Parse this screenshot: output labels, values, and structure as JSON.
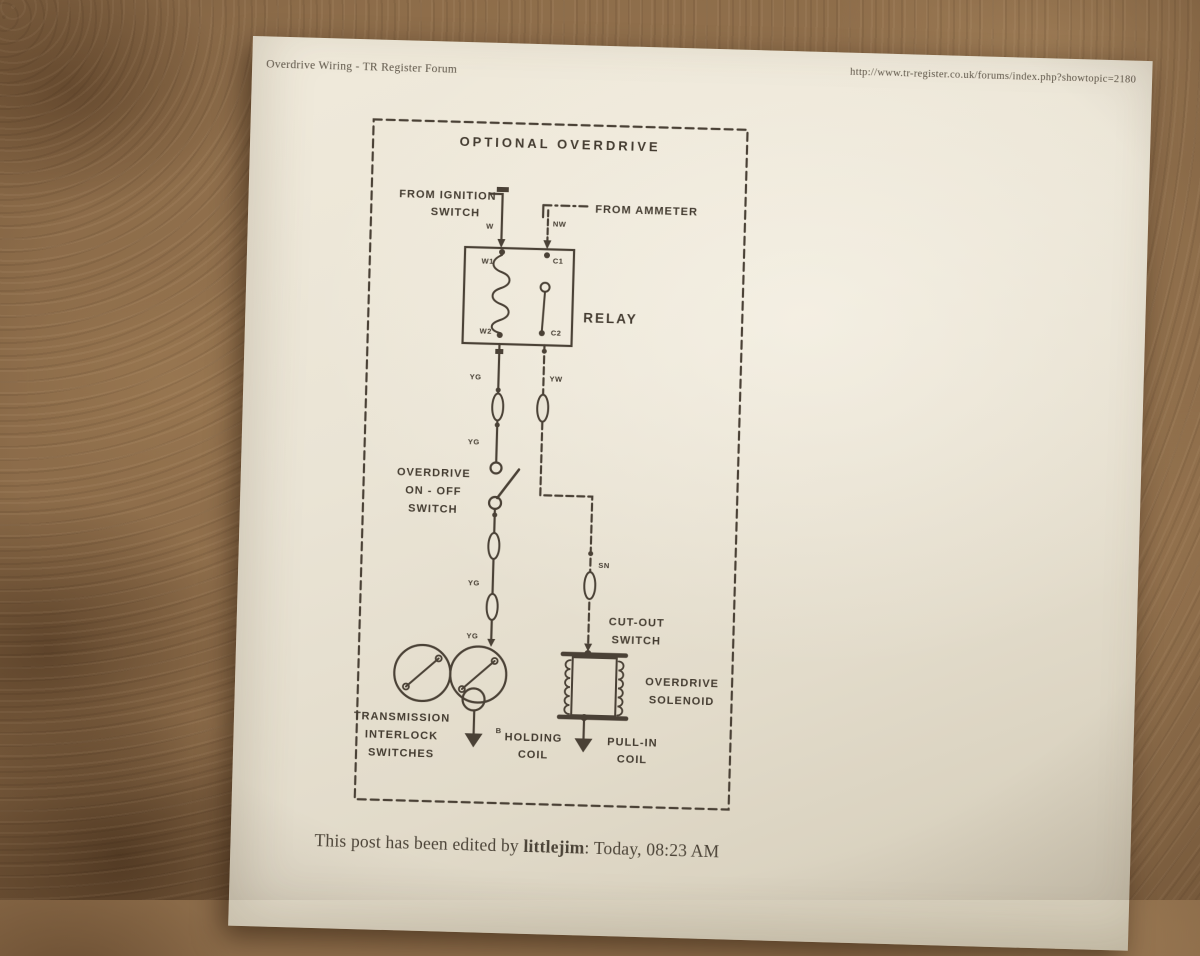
{
  "header": {
    "title": "Overdrive Wiring - TR Register Forum",
    "url": "http://www.tr-register.co.uk/forums/index.php?showtopic=2180"
  },
  "diagram": {
    "title": "OPTIONAL OVERDRIVE",
    "labels": {
      "ignition": [
        "FROM IGNITION",
        "SWITCH"
      ],
      "ammeter": "FROM AMMETER",
      "relay": "RELAY",
      "onoff": [
        "OVERDRIVE",
        "ON - OFF",
        "SWITCH"
      ],
      "cutout": [
        "CUT-OUT",
        "SWITCH"
      ],
      "solenoid": [
        "OVERDRIVE",
        "SOLENOID"
      ],
      "interlock": [
        "TRANSMISSION",
        "INTERLOCK",
        "SWITCHES"
      ],
      "holding": [
        "HOLDING",
        "COIL"
      ],
      "pullin": [
        "PULL-IN",
        "COIL"
      ],
      "b_terminal": "B"
    },
    "terminals": {
      "w1": "W1",
      "c1": "C1",
      "w2": "W2",
      "c2": "C2"
    },
    "wire_codes": {
      "w": "W",
      "nw": "NW",
      "yg": "YG",
      "yw": "YW",
      "sn": "SN"
    }
  },
  "footer": {
    "prefix": "This post has been edited by ",
    "user": "littlejim",
    "suffix": ": Today, 08:23 AM"
  },
  "colors": {
    "carpet": "#8a6a48",
    "paper": "#eae4d5",
    "ink": "#4a4136"
  }
}
